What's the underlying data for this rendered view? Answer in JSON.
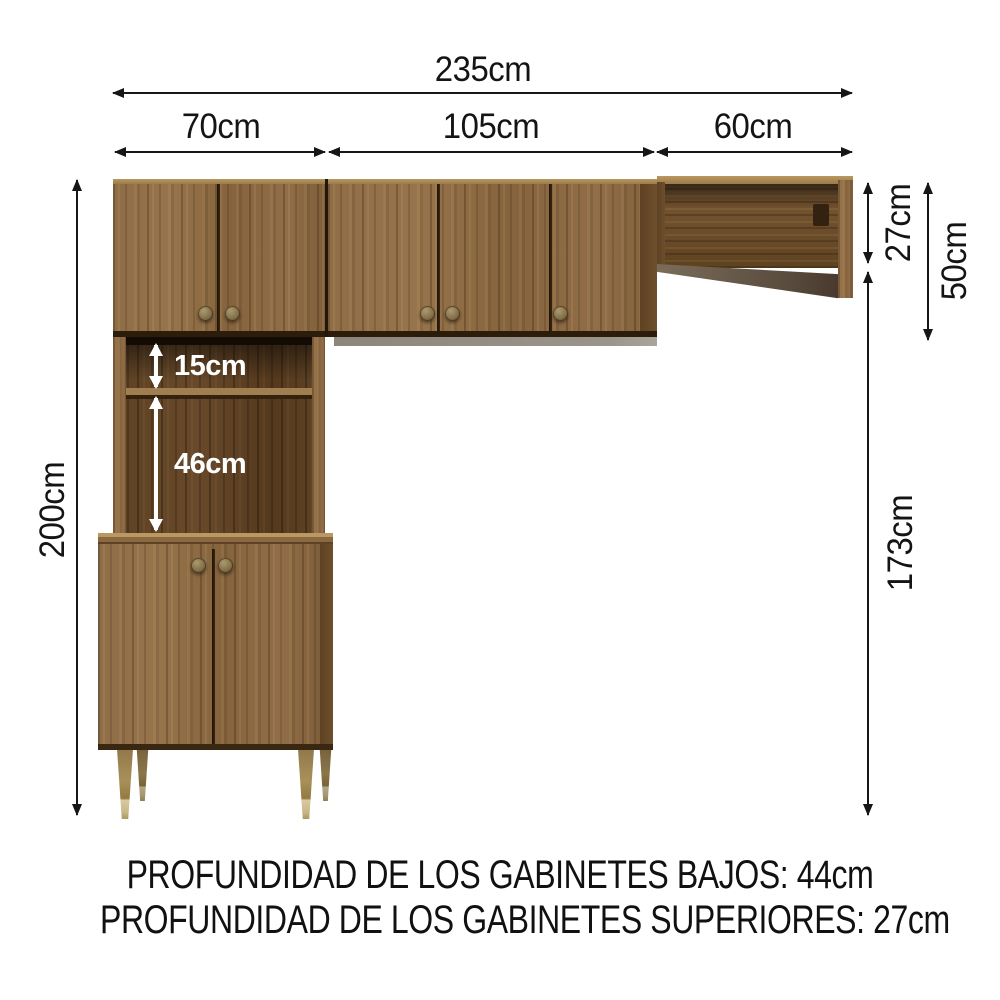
{
  "dimensions": {
    "total_width": "235cm",
    "left_section_width": "70cm",
    "middle_section_width": "105cm",
    "right_section_width": "60cm",
    "total_height": "200cm",
    "open_shelf_height": "27cm",
    "upper_cabinet_height": "50cm",
    "lower_section_height": "173cm",
    "niche_top_height": "15cm",
    "niche_bottom_height": "46cm"
  },
  "footer": {
    "line1": "PROFUNDIDAD DE LOS GABINETES BAJOS: 44cm",
    "line2": "PROFUNDIDAD DE LOS GABINETES SUPERIORES: 27cm"
  },
  "colors": {
    "annotation": "#161616",
    "wood_front": "#8f6d46",
    "wood_interior": "#5d4224",
    "interior_label": "#ffffff",
    "leg_gold": "#a8905a",
    "shadow_gray": "#8e857a"
  }
}
